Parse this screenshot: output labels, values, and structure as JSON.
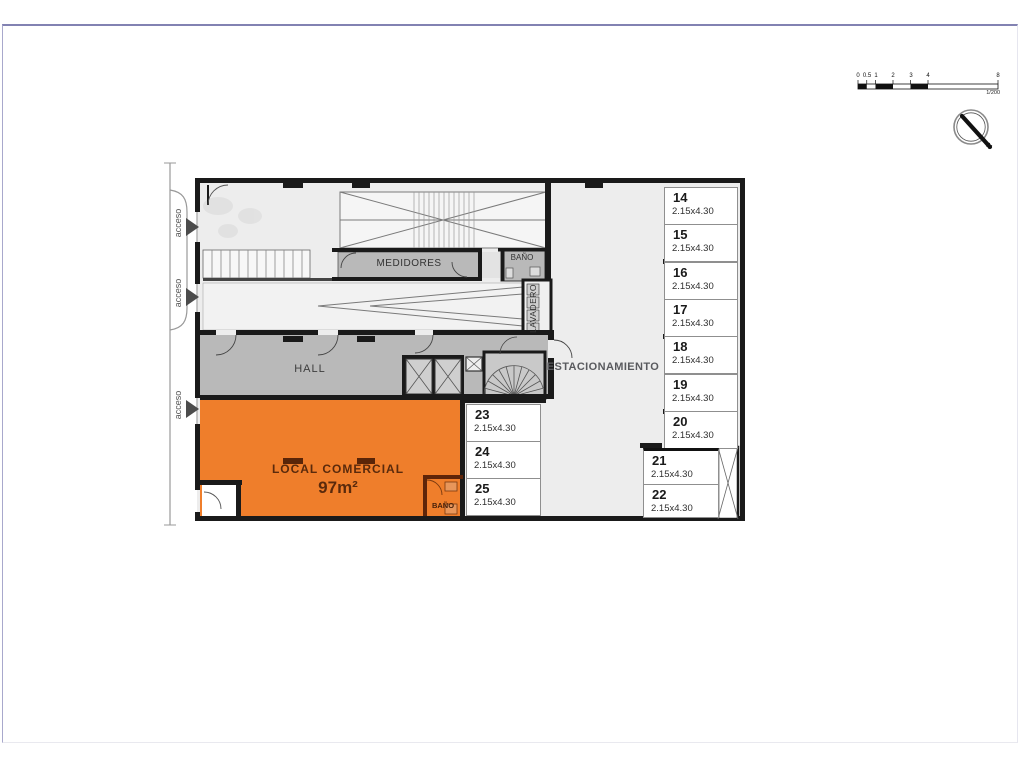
{
  "plan": {
    "rooms": {
      "medidores": "MEDIDORES",
      "bano_top": "BAÑO",
      "lavadero": "LAVADERO",
      "hall": "HALL",
      "estacionamiento": "ESTACIONAMIENTO",
      "local_comercial": "LOCAL COMERCIAL",
      "local_area": "97m²",
      "bano_local": "BAÑO"
    },
    "acceso": [
      "acceso",
      "acceso",
      "acceso"
    ],
    "parking": {
      "spots": [
        {
          "number": "14",
          "dims": "2.15x4.30"
        },
        {
          "number": "15",
          "dims": "2.15x4.30"
        },
        {
          "number": "16",
          "dims": "2.15x4.30"
        },
        {
          "number": "17",
          "dims": "2.15x4.30"
        },
        {
          "number": "18",
          "dims": "2.15x4.30"
        },
        {
          "number": "19",
          "dims": "2.15x4.30"
        },
        {
          "number": "20",
          "dims": "2.15x4.30"
        },
        {
          "number": "21",
          "dims": "2.15x4.30"
        },
        {
          "number": "22",
          "dims": "2.15x4.30"
        },
        {
          "number": "23",
          "dims": "2.15x4.30"
        },
        {
          "number": "24",
          "dims": "2.15x4.30"
        },
        {
          "number": "25",
          "dims": "2.15x4.30"
        }
      ]
    },
    "scale_bar": {
      "labels": [
        "0",
        "0.5",
        "1",
        "2",
        "3",
        "4",
        "8"
      ],
      "ratio": "1/200"
    },
    "compass": {
      "label": "N"
    },
    "colors": {
      "local_orange": "#ef7e2b",
      "room_gray": "#b9b9b9",
      "floor_gray": "#ededed",
      "wall_black": "#1a1a1a",
      "local_wall_brown": "#5f2509"
    }
  }
}
